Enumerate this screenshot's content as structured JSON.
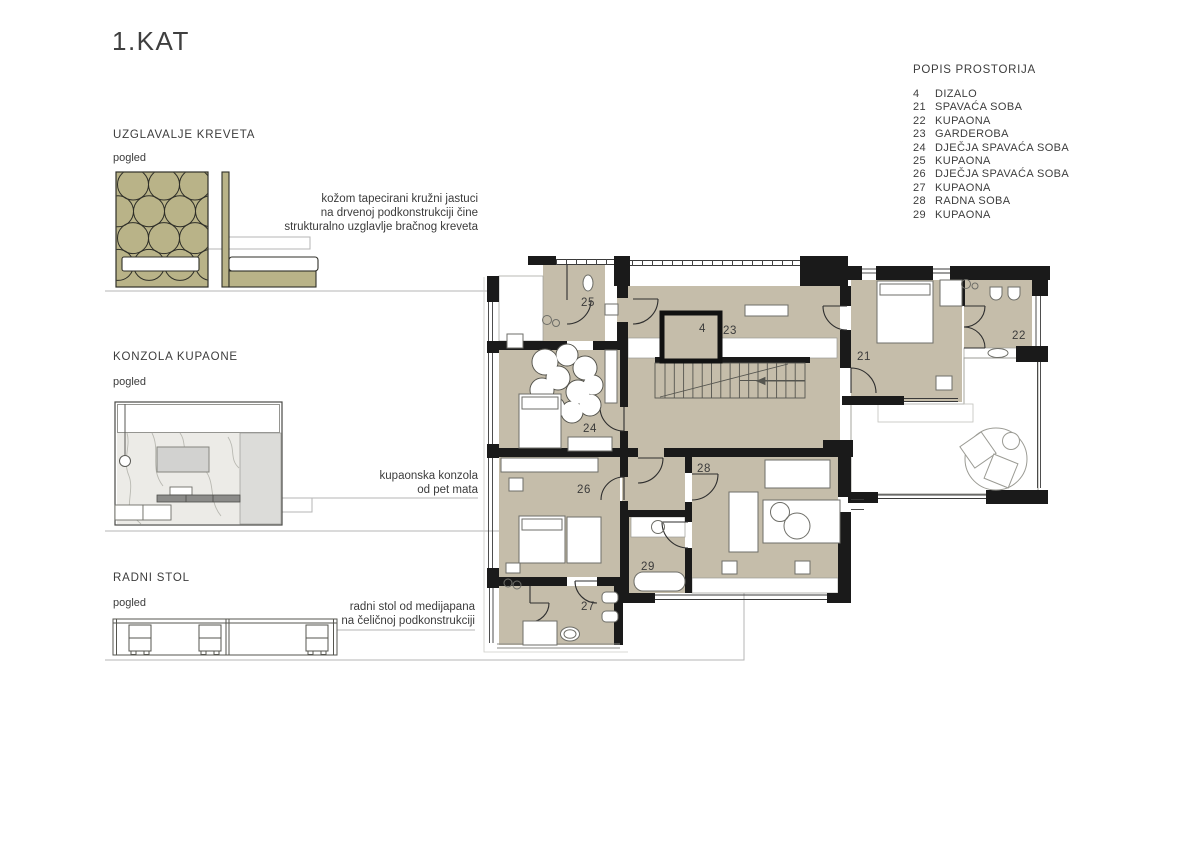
{
  "title": "1.KAT",
  "colors": {
    "floor_beige": "#c5bdaa",
    "cushion_olive": "#b9b388",
    "wall_black": "#1a1a1a",
    "leader_gray": "#b5b5b5",
    "marble_light": "#ecebe7",
    "panel_gray": "#dcdcd9",
    "shelf_dark": "#8b8b89",
    "text": "#3d3d3d"
  },
  "room_list": {
    "heading": "POPIS PROSTORIJA",
    "items": [
      {
        "no": "4",
        "name": "DIZALO"
      },
      {
        "no": "21",
        "name": "SPAVAĆA SOBA"
      },
      {
        "no": "22",
        "name": "KUPAONA"
      },
      {
        "no": "23",
        "name": "GARDEROBA"
      },
      {
        "no": "24",
        "name": "DJEČJA SPAVAĆA SOBA"
      },
      {
        "no": "25",
        "name": "KUPAONA"
      },
      {
        "no": "26",
        "name": "DJEČJA SPAVAĆA SOBA"
      },
      {
        "no": "27",
        "name": "KUPAONA"
      },
      {
        "no": "28",
        "name": "RADNA SOBA"
      },
      {
        "no": "29",
        "name": "KUPAONA"
      }
    ]
  },
  "details": {
    "headboard": {
      "heading": "UZGLAVALJE KREVETA",
      "view_label": "pogled",
      "annotation_lines": [
        "kožom tapecirani kružni jastuci",
        "na drvenoj podkonstrukciji čine",
        "strukturalno uzglavlje bračnog kreveta"
      ]
    },
    "console": {
      "heading": "KONZOLA KUPAONE",
      "view_label": "pogled",
      "annotation_lines": [
        "kupaonska konzola",
        "od pet mata"
      ]
    },
    "desk": {
      "heading": "RADNI STOL",
      "view_label": "pogled",
      "annotation_lines": [
        "radni stol od medijapana",
        "na čeličnoj podkonstrukciji"
      ]
    }
  },
  "plan": {
    "labels": {
      "r4": "4",
      "r21": "21",
      "r22": "22",
      "r23": "23",
      "r24": "24",
      "r25": "25",
      "r26": "26",
      "r27": "27",
      "r28": "28",
      "r29": "29"
    }
  }
}
